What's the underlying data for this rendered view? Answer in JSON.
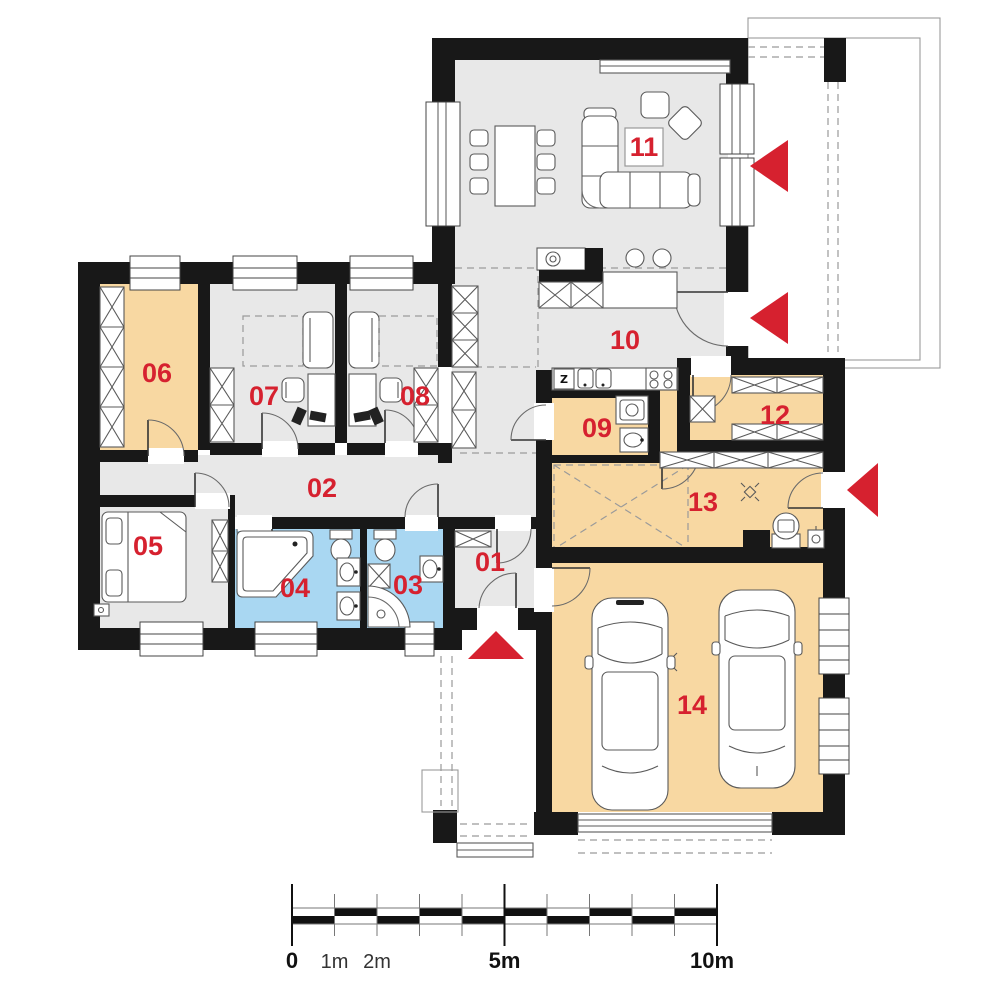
{
  "document": {
    "kind": "single-storey house floor plan",
    "colors": {
      "accent_red": "#d6212f",
      "floor_gray": "#e8e8e8",
      "floor_orange": "#f8d8a2",
      "floor_blue": "#a9d7f2",
      "wall_black": "#181818"
    }
  },
  "rooms": [
    {
      "number": "01"
    },
    {
      "number": "02"
    },
    {
      "number": "03"
    },
    {
      "number": "04"
    },
    {
      "number": "05"
    },
    {
      "number": "06"
    },
    {
      "number": "07"
    },
    {
      "number": "08"
    },
    {
      "number": "09"
    },
    {
      "number": "10"
    },
    {
      "number": "11"
    },
    {
      "number": "12"
    },
    {
      "number": "13"
    },
    {
      "number": "14"
    }
  ],
  "kitchen": {
    "fridge_symbol": "Z"
  },
  "scale_bar": {
    "tick_labels": [
      "0",
      "1m",
      "2m",
      "5m",
      "10m"
    ]
  }
}
